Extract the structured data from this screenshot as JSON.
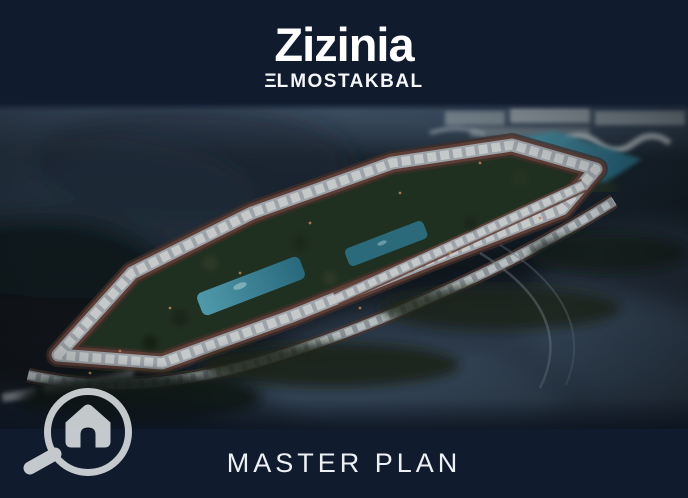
{
  "brand": {
    "name": "Zizinia",
    "sub_mark": "ΞL",
    "sub_name": "MOSTAKBAL"
  },
  "footer": {
    "title": "MASTER PLAN"
  },
  "photo": {
    "alt": "Aerial dusk view of the Zizinia El Mostakbal compound master plan: elongated loop of white row buildings with red-brown access roads, green courtyards, turquoise pools, a lagoon on the right and misty dark terrain around"
  },
  "icons": {
    "magnifier_house": "magnifier-house-icon"
  },
  "colors": {
    "background_navy": "#101b2e",
    "text_white": "#f2f4f6",
    "icon_gray": "#d3d8da",
    "building_row": "#c2c9cc",
    "road_brown": "#6e4538",
    "pool_teal": "#3e93a8",
    "lagoon_teal": "#4aa0b4",
    "courtyard_green": "#24331f"
  }
}
